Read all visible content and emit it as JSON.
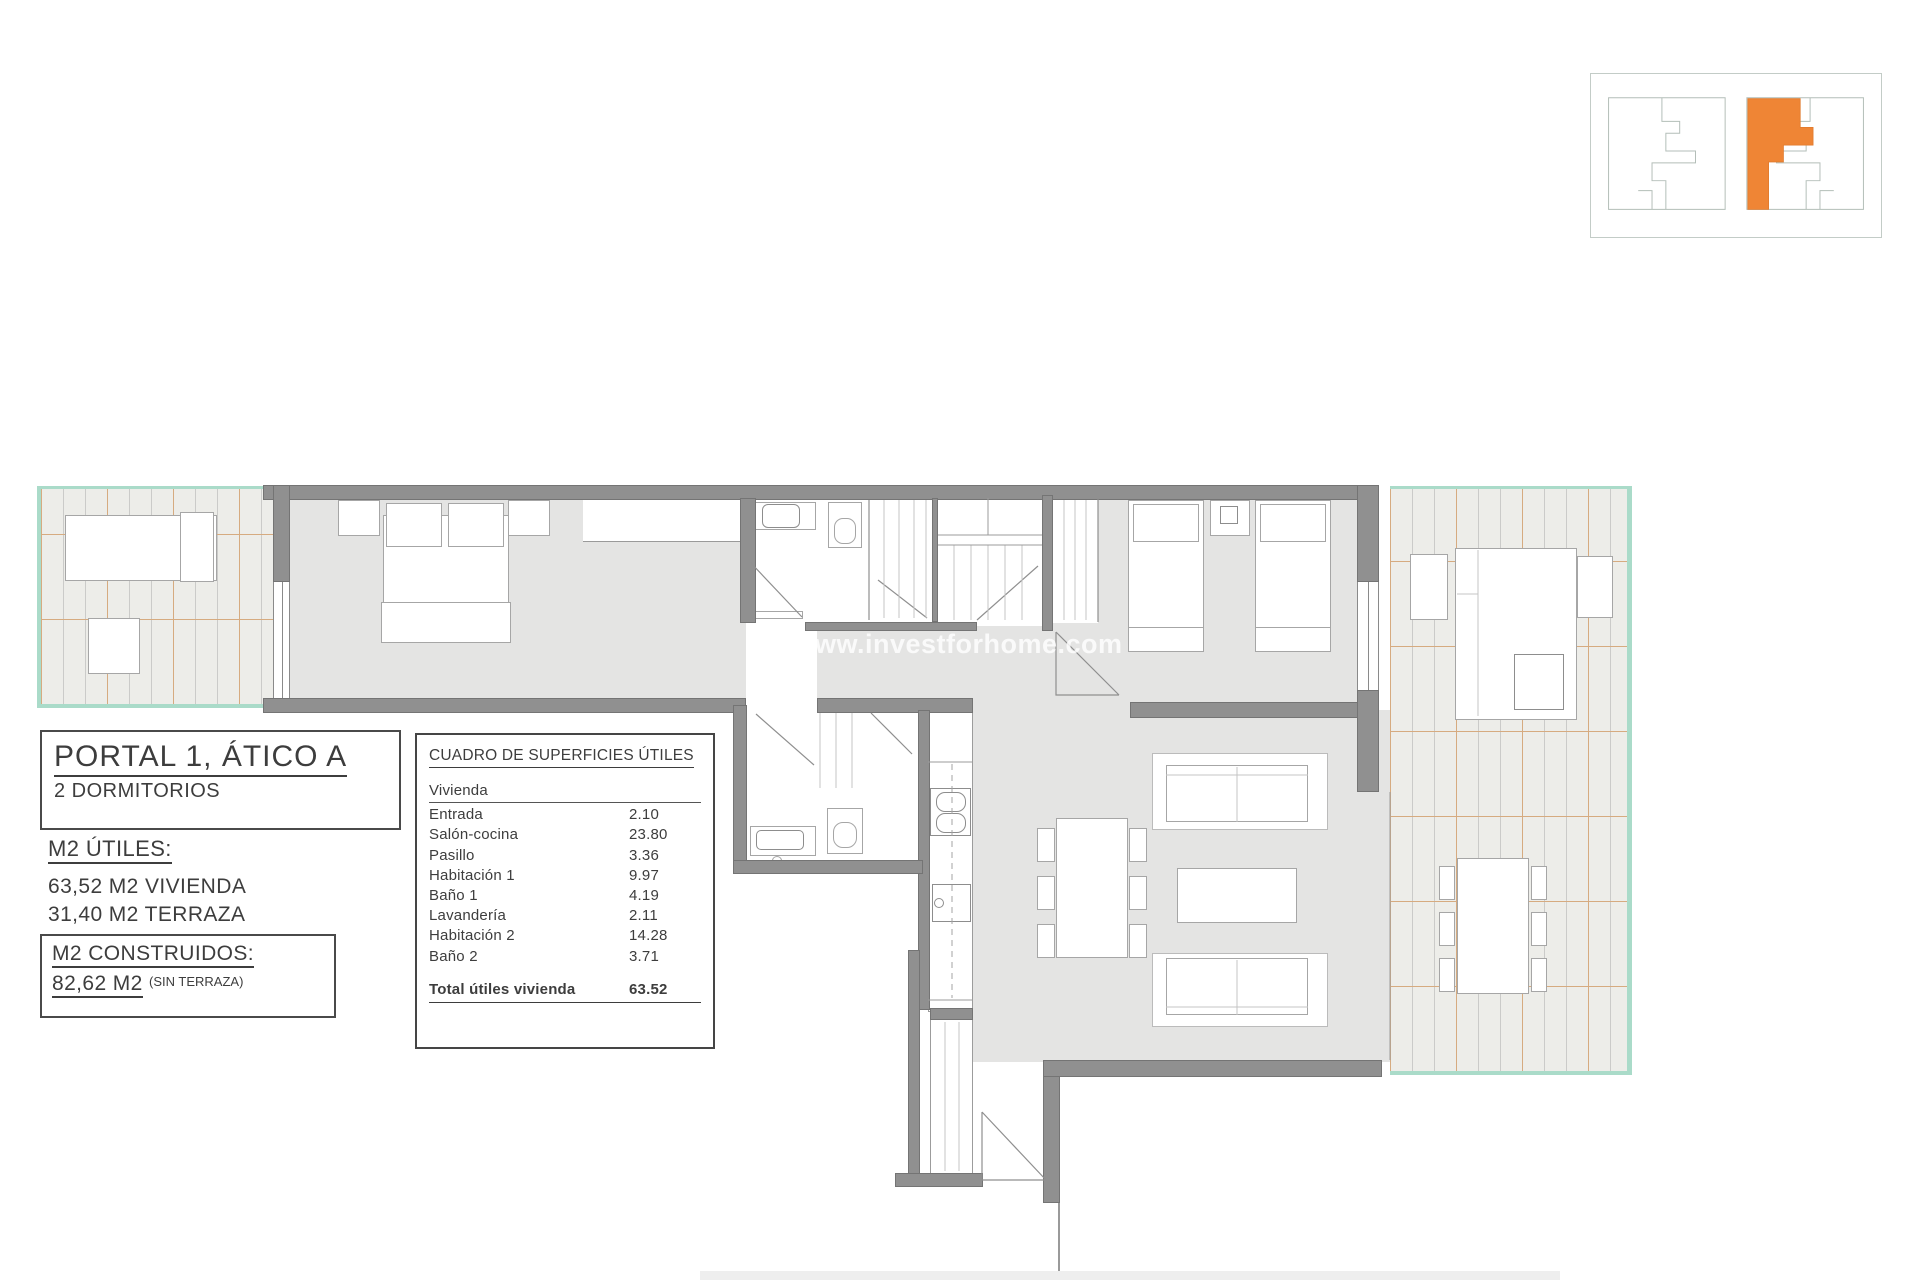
{
  "watermark": {
    "text": "www.investforhome.com"
  },
  "title_block": {
    "title": "PORTAL 1, ÁTICO A",
    "subtitle": "2 DORMITORIOS"
  },
  "areas_block": {
    "utiles_label": "M2 ÚTILES:",
    "utiles_lines": [
      "63,52 M2 VIVIENDA",
      "31,40 M2 TERRAZA"
    ],
    "construidos_label": "M2 CONSTRUIDOS:",
    "construidos_value": "82,62 M2",
    "construidos_note": "(SIN TERRAZA)"
  },
  "surface_table": {
    "title": "CUADRO DE SUPERFICIES ÚTILES",
    "section": "Vivienda",
    "rows": [
      {
        "label": "Entrada",
        "value": "2.10"
      },
      {
        "label": "Salón-cocina",
        "value": "23.80"
      },
      {
        "label": "Pasillo",
        "value": "3.36"
      },
      {
        "label": "Habitación 1",
        "value": "9.97"
      },
      {
        "label": "Baño 1",
        "value": "4.19"
      },
      {
        "label": "Lavandería",
        "value": "2.11"
      },
      {
        "label": "Habitación 2",
        "value": "14.28"
      },
      {
        "label": "Baño 2",
        "value": "3.71"
      }
    ],
    "total_label": "Total útiles vivienda",
    "total_value": "63.52"
  },
  "colors": {
    "wall_gray": "#909090",
    "floor_gray": "#e4e4e3",
    "terrace_fill": "#edede9",
    "terrace_border_teal": "#aadbc9",
    "hatch_tan": "#d6ab80",
    "keyplan_highlight_orange": "#ef8535",
    "watermark_white": "rgba(255,255,255,0.8)"
  }
}
